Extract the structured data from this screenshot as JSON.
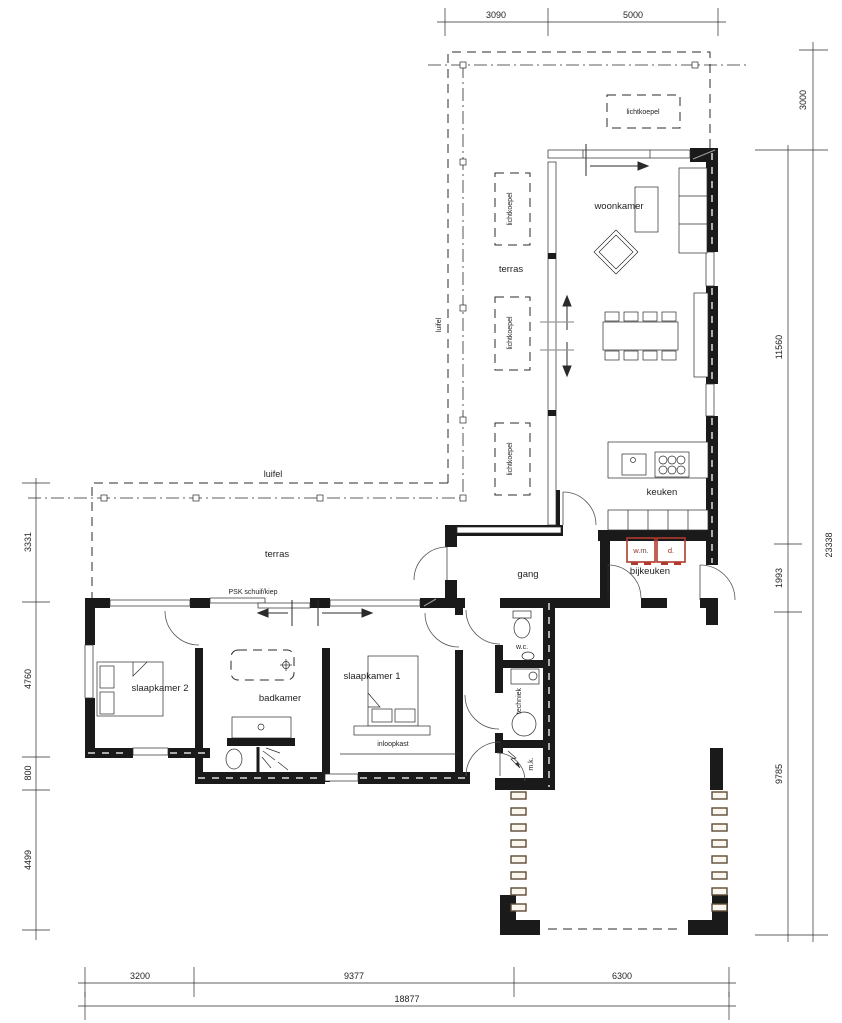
{
  "title": "floor-plan",
  "labels": {
    "woonkamer": "woonkamer",
    "terras": "terras",
    "keuken": "keuken",
    "bijkeuken": "bijkeuken",
    "gang": "gang",
    "wc": "w.c.",
    "techniek": "techniek",
    "mk": "m.k.",
    "slaapkamer1": "slaapkamer 1",
    "slaapkamer2": "slaapkamer 2",
    "badkamer": "badkamer",
    "inloopkast": "inloopkast",
    "luifel": "luifel",
    "lichtkoepel": "lichtkoepel",
    "psk": "PSK schuif/kiep",
    "wm": "w.m.",
    "d": "d."
  },
  "dimensions": {
    "top": [
      "3090",
      "5000"
    ],
    "right_outer": [
      "3000",
      "23338"
    ],
    "right_inner": [
      "11560",
      "1993",
      "9785"
    ],
    "left": [
      "3331",
      "4760",
      "800",
      "4499"
    ],
    "bottom": [
      "3200",
      "9377",
      "6300"
    ],
    "bottom_total": "18877"
  },
  "colors": {
    "wall": "#1a1a1a",
    "appliance_red": "#b03a2e",
    "post_brown": "#5d4a37",
    "line": "#2b2b2b"
  }
}
